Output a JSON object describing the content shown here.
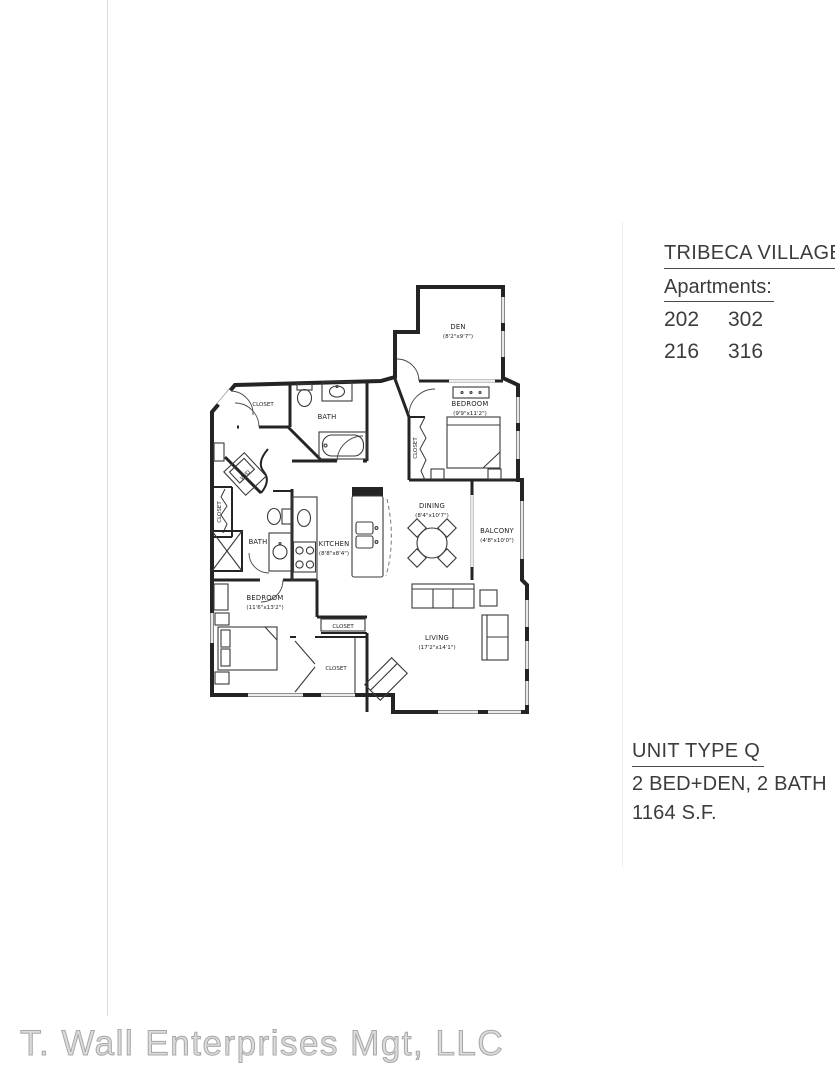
{
  "header": {
    "title": "TRIBECA VILLAGE",
    "subtitle": "Apartments:",
    "units": [
      "202",
      "302",
      "216",
      "316"
    ]
  },
  "unit_summary": {
    "type": "UNIT TYPE Q",
    "layout": "2 BED+DEN, 2 BATH",
    "area": "1164 S.F."
  },
  "footer": {
    "company": "T. Wall Enterprises Mgt, LLC"
  },
  "floorplan": {
    "den": {
      "name": "DEN",
      "dims": "(8'2\"x9'7\")"
    },
    "bedroom_upper": {
      "name": "BEDROOM",
      "dims": "(9'9\"x11'2\")"
    },
    "bedroom_lower": {
      "name": "BEDROOM",
      "dims": "(11'6\"x13'2\")"
    },
    "kitchen": {
      "name": "KITCHEN",
      "dims": "(8'8\"x8'4\")"
    },
    "dining": {
      "name": "DINING",
      "dims": "(8'4\"x10'7\")"
    },
    "balcony": {
      "name": "BALCONY",
      "dims": "(4'8\"x10'0\")"
    },
    "living": {
      "name": "LIVING",
      "dims": "(17'2\"x14'1\")"
    },
    "bath": {
      "name": "BATH"
    },
    "closet": {
      "name": "CLOSET"
    },
    "washer_dryer": {
      "name": "W/D"
    }
  },
  "colors": {
    "wall": "#242424",
    "text": "#3c3c3c",
    "watermark": "#bdbdbd",
    "scan_artifact": "#dcdcdc"
  }
}
